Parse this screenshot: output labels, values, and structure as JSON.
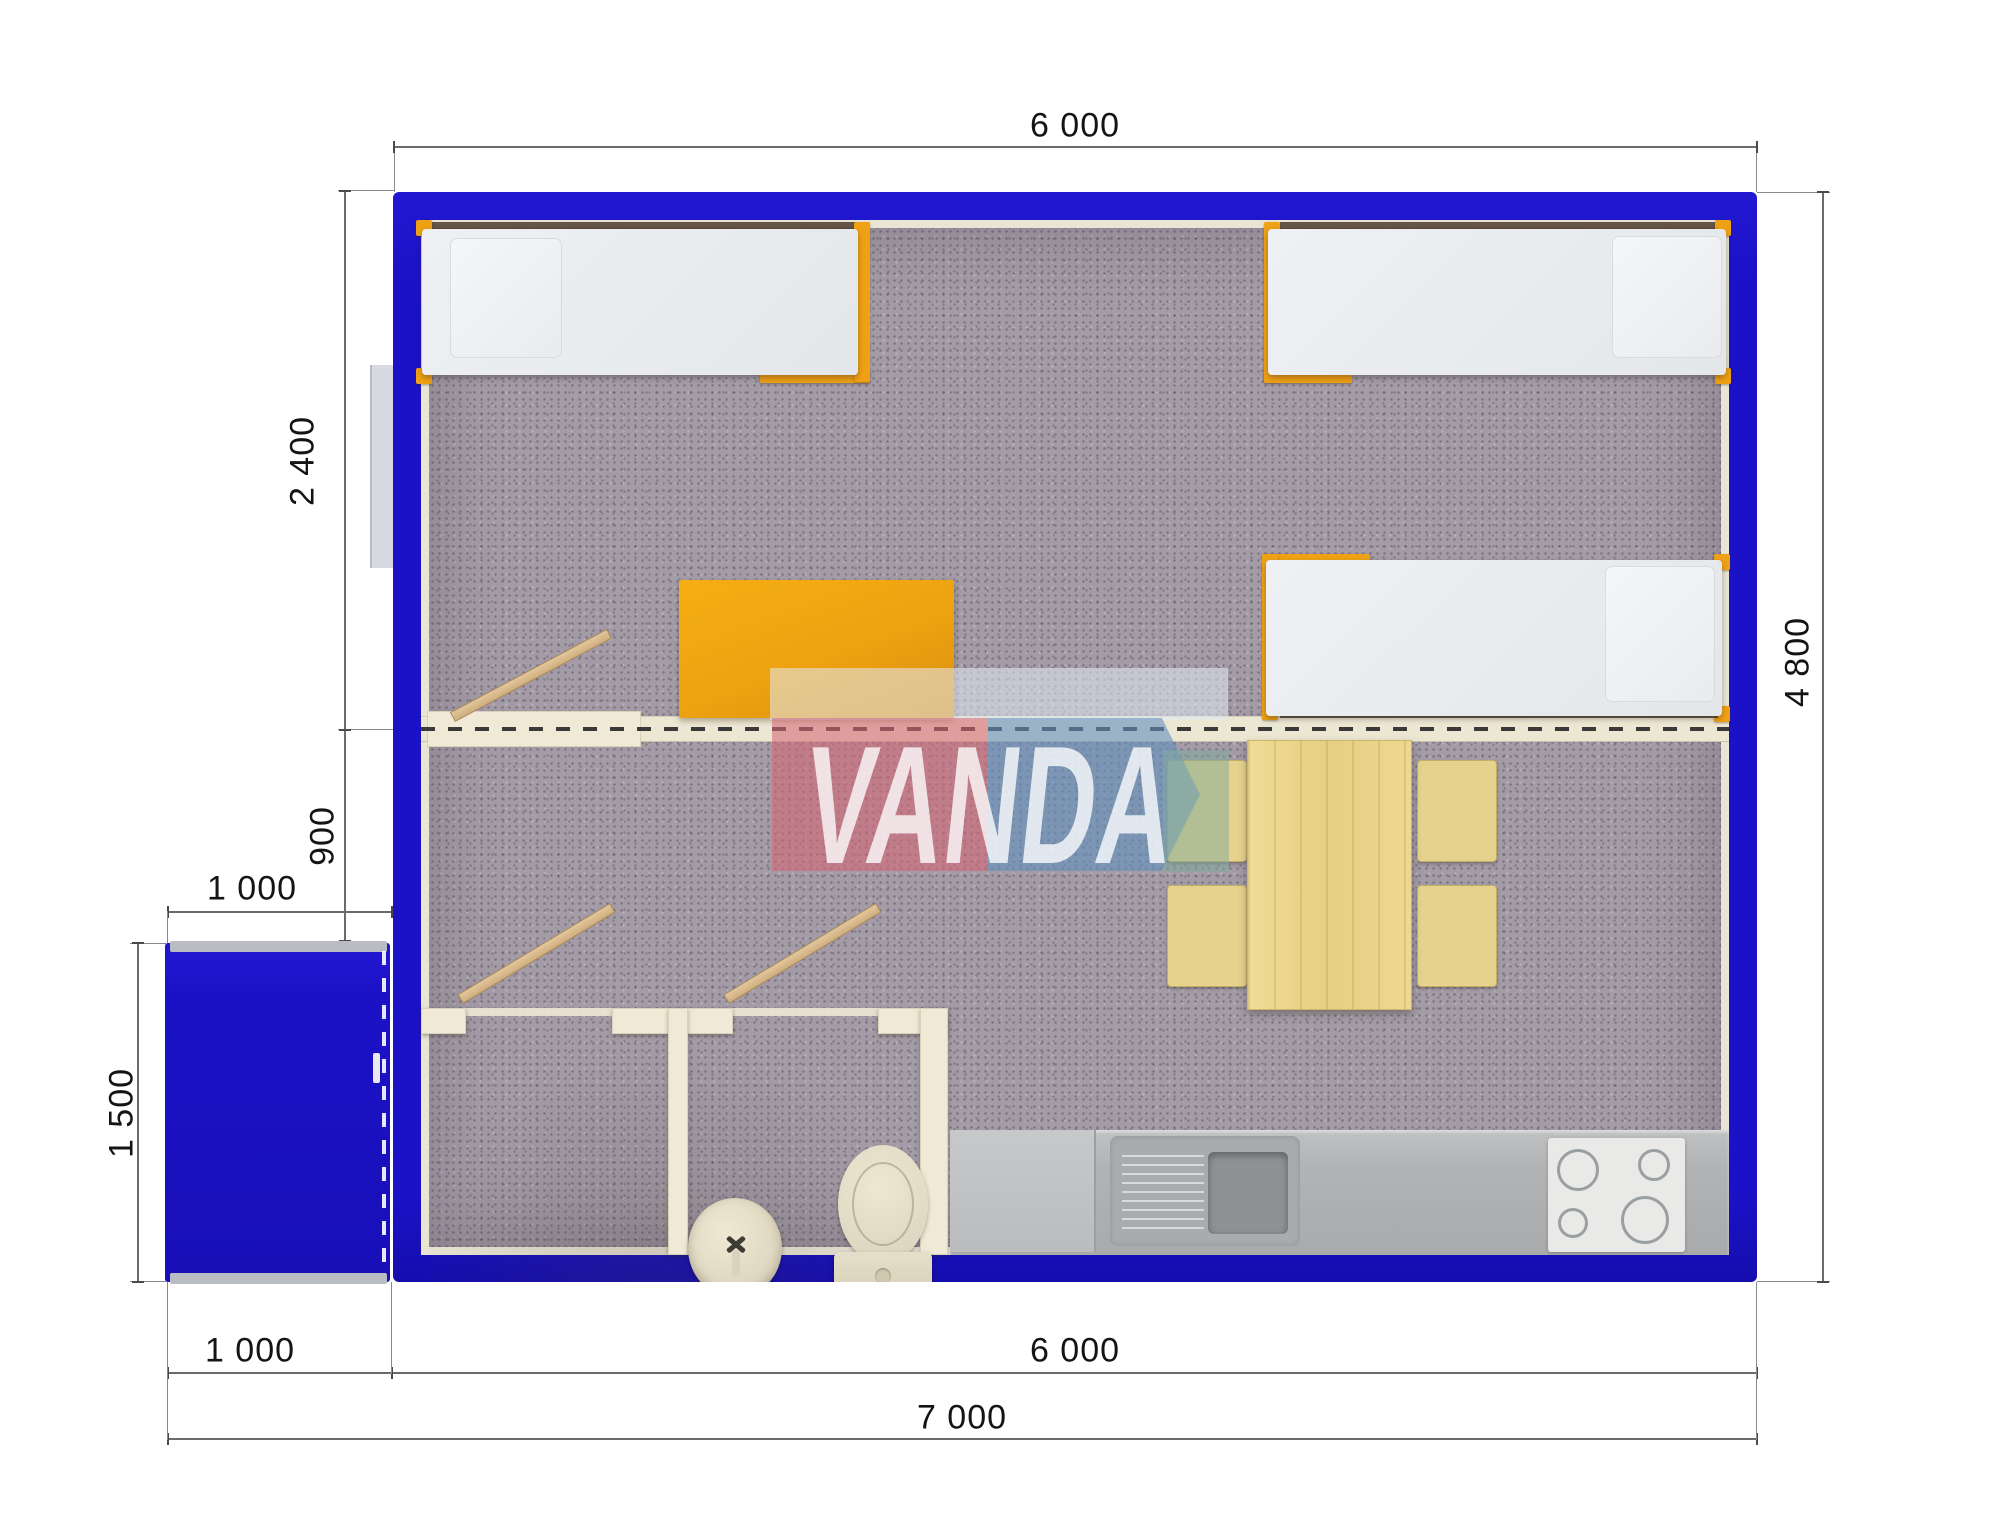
{
  "scene": {
    "description": "Top-down 3D rendered floor plan of a modular cabin with blue container walls and entry porch",
    "watermark_text": "VANDA"
  },
  "dimensions": {
    "top_width": "6 000",
    "bedroom_depth": "2 400",
    "hall_offset": "900",
    "porch_width_top": "1 000",
    "porch_depth": "1 500",
    "right_height": "4 800",
    "bottom_porch_width": "1 000",
    "bottom_main_width": "6 000",
    "bottom_total_width": "7 000"
  },
  "colors": {
    "wall_blue": "#1b12c7",
    "frame_orange": "#efa115",
    "carpet_gray": "#a39ba5",
    "partition_cream": "#efe9d6",
    "counter_gray": "#b3b5b7",
    "table_wood": "#ecd78f",
    "watermark_pink": "#d66876",
    "watermark_blue": "#6491be"
  },
  "furniture": {
    "beds": [
      "bed-top-left",
      "bed-top-right",
      "bed-middle-right"
    ],
    "desk": "orange-desk",
    "dining": [
      "dining-table",
      "chair x4"
    ],
    "bathroom": [
      "wash-basin",
      "toilet"
    ],
    "kitchen": [
      "kitchen-counter",
      "kitchen-sink",
      "stove-4-burners"
    ],
    "doors": [
      "bedroom-door",
      "hall-door",
      "bathroom-door"
    ],
    "porch": "entry-porch"
  }
}
